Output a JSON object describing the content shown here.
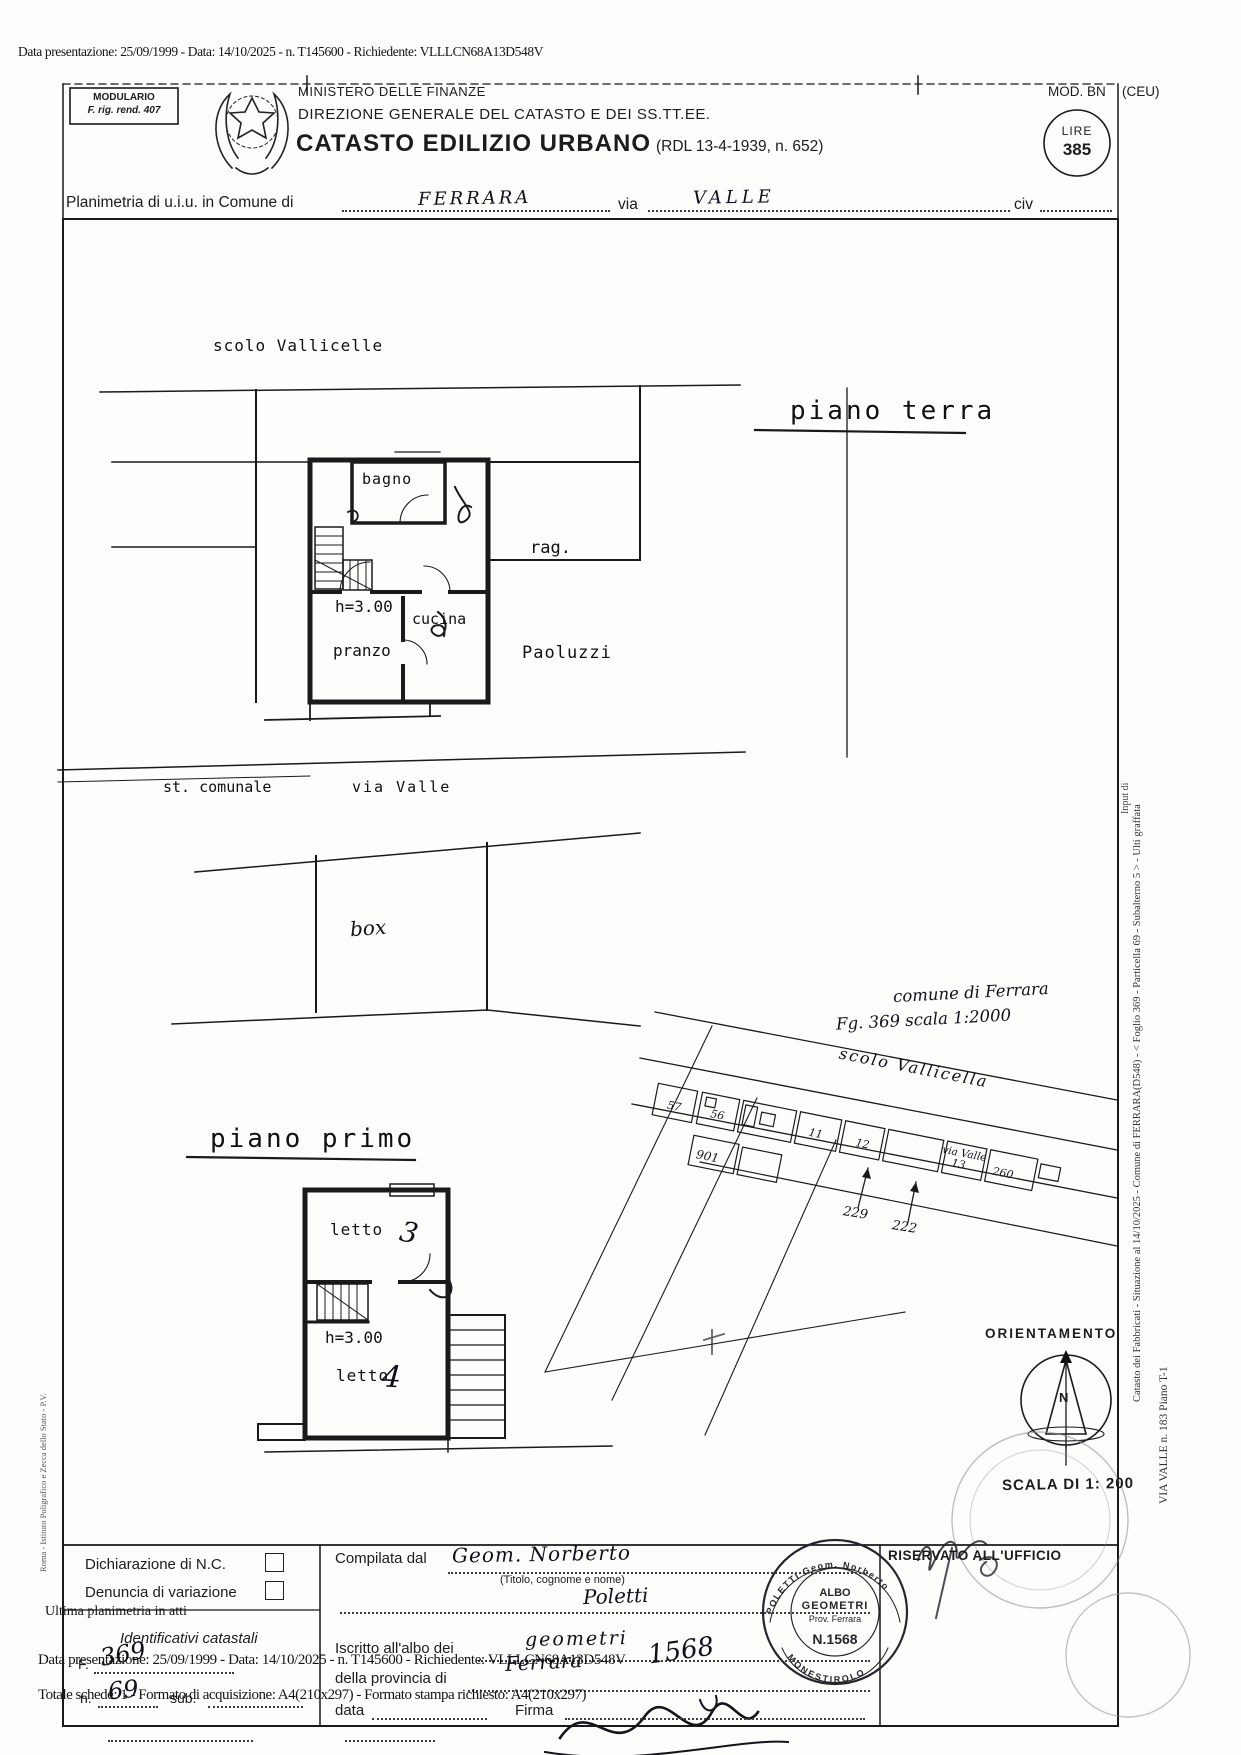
{
  "header": {
    "presentation_line": "Data presentazione: 25/09/1999 - Data: 14/10/2025 - n. T145600 - Richiedente: VLLLCN68A13D548V",
    "modulario_title": "MODULARIO",
    "modulario_sub": "F. rig. rend. 407",
    "ministry": "MINISTERO DELLE FINANZE",
    "directorate": "DIREZIONE GENERALE DEL CATASTO E DEI SS.TT.EE.",
    "register_title": "CATASTO EDILIZIO URBANO",
    "register_ref": "(RDL 13-4-1939, n. 652)",
    "mod_label": "MOD. BN",
    "mod_suffix": "(CEU)",
    "lire_word": "LIRE",
    "lire_amount": "385"
  },
  "subject": {
    "prefix": "Planimetria di u.i.u. in Comune di",
    "comune": "FERRARA",
    "via_label": "via",
    "via_value": "VALLE",
    "civ_label": "civ"
  },
  "plan_ground": {
    "title": "piano terra",
    "canal": "scolo Vallicelle",
    "road": "st. comunale",
    "road2": "via Valle",
    "room_bath": "bagno",
    "room_kitchen": "cucina",
    "room_dining": "pranzo",
    "height": "h=3.00",
    "neighbor_title": "rag.",
    "neighbor_name": "Paoluzzi",
    "garage": "box"
  },
  "plan_first": {
    "title": "piano primo",
    "room_bed_top": "letto",
    "room_bed_top_no": "3",
    "height": "h=3.00",
    "room_bed_bottom": "letto",
    "room_bed_bottom_no": "4"
  },
  "map": {
    "comune_note": "comune di Ferrara",
    "sheet_note": "Fg. 369 scala 1:2000",
    "canal": "scolo Vallicella",
    "road": "via Valle",
    "parcels": [
      "57",
      "56",
      "11",
      "12",
      "13",
      "260",
      "901"
    ],
    "mark_a": "229",
    "mark_b": "222",
    "orientation": "ORIENTAMENTO",
    "north": "N",
    "scale": "SCALA DI 1: 200"
  },
  "margins": {
    "right_main": "Catasto dei Fabbricati - Situazione al 14/10/2025 - Comune di FERRARA(D548) - < Foglio 369 - Particella 69 - Subalterno 5 > - Ulti graffata",
    "right_sub": "VIA VALLE n. 183 Piano T-1",
    "right_small": "Input di",
    "left_note": "Roma - Istituto Poligrafico e Zecca dello Stato - P.V."
  },
  "footer": {
    "decl_nc": "Dichiarazione di N.C.",
    "decl_var": "Denuncia di variazione",
    "last_plan": "Ultima planimetria in atti",
    "cadastral_ids": "Identificativi catastali",
    "f_label": "F.",
    "f_value": "369",
    "n_label": "n.",
    "n_value": "69",
    "sub_label": "sub.",
    "overprint_1": "Data presentazione: 25/09/1999 - Data: 14/10/2025 - n. T145600 - Richiedente: VLLLCN68A13D548V",
    "overprint_2": "Totale schede: 1 - Formato di acquisizione: A4(210x297) - Formato stampa richiesto: A4(210x297)",
    "compiled_by": "Compilata dal",
    "compiled_value": "Geom.   Norberto",
    "name_hint": "(Titolo, cognome e nome)",
    "surname_value": "Poletti",
    "registered": "Iscritto all'albo dei",
    "registered_value": "geometri",
    "province": "della provincia di",
    "province_value": "Ferrara",
    "albo_number": "1568",
    "date_label": "data",
    "sign_label": "Firma",
    "office_header": "RISERVATO ALL'UFFICIO",
    "stamp_top": "ALBO",
    "stamp_mid": "GEOMETRI",
    "stamp_sub": "Prov. Ferrara",
    "stamp_no": "N.1568",
    "stamp_rim_top": "POLETTI Geom. Norberto",
    "stamp_rim_bottom": "MONESTIROLO"
  }
}
